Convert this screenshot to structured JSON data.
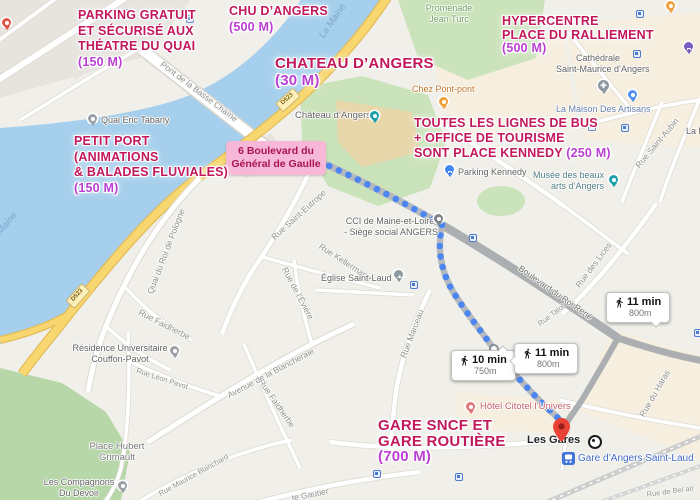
{
  "annotations": {
    "parking_quai": {
      "line1": "PARKING GRATUIT",
      "line2": "ET SÉCURISÉ AUX",
      "line3": "THÉATRE DU QUAI",
      "distance": "(150 M)"
    },
    "chu": {
      "line1": "CHU D’ANGERS",
      "distance": "(500 M)"
    },
    "chateau": {
      "line1": "CHATEAU D’ANGERS",
      "distance": "(30 M)"
    },
    "hypercentre": {
      "line1": "HYPERCENTRE",
      "line2": "PLACE DU RALLIEMENT",
      "distance": "(500 M)"
    },
    "bus_office": {
      "line1": "TOUTES LES LIGNES DE BUS",
      "line2": "+ OFFICE DE TOURISME",
      "line3": "SONT PLACE KENNEDY",
      "distance": "(250 M)"
    },
    "petit_port": {
      "line1": "PETIT PORT",
      "line2": "(ANIMATIONS",
      "line3": "& BALADES FLUVIALES)",
      "distance": "(150 M)"
    },
    "gare": {
      "line1": "GARE SNCF ET",
      "line2": "GARE ROUTIÈRE",
      "distance": "(700 M)"
    }
  },
  "address_box": {
    "line1": "6 Boulevard du",
    "line2": "Général de Gaulle"
  },
  "route_badges": [
    {
      "time": "10 min",
      "distance": "750m"
    },
    {
      "time": "11 min",
      "distance": "800m"
    },
    {
      "time": "11 min",
      "distance": "800m"
    }
  ],
  "pois": {
    "quai_tabarly": "Quai Eric Tabarly",
    "promenade1": "Promenade",
    "promenade2": "Jean Turc",
    "chez_pont_pont": "Chez Pont-pont",
    "chateau_label": "Château d’Angers",
    "cathedrale1": "Cathédrale",
    "cathedrale2": "Saint-Maurice d’Angers",
    "maison_artisans": "La Maison Des Artisans",
    "musee1": "Musée des beaux",
    "musee2": "arts d’Angers",
    "parking_kennedy": "Parking Kennedy",
    "cci1": "CCI de Maine-et-Loire",
    "cci2": "- Siège social ANGERS",
    "eglise": "Église Saint-Laud",
    "residence1": "Résidence Universitaire",
    "residence2": "Couffon-Pavot",
    "place_hubert1": "Place Hubert",
    "place_hubert2": "Grimault",
    "compagnons1": "Les Compagnons",
    "compagnons2": "Du Devoir",
    "hotel": "Hôtel Citotel l’Univers",
    "les_gares": "Les Gares",
    "gare_saint_laud": "Gare d’Angers Saint-Laud",
    "la_pr": "La Pr"
  },
  "streets": {
    "pont_basse_chaine": "Pont de la Basse Chaîne",
    "la_maine": "La Maine",
    "quai_roi_pologne": "Quai du Roi de Pologne",
    "rue_faidherbe": "Rue Faidherbe",
    "rue_saint_eutrope": "Rue Saint-Eutrope",
    "rue_kellermann": "Rue Kellermann",
    "rue_eviere": "Rue de l’Évière",
    "rue_marceau": "Rue Marceau",
    "bd_roi_rene": "Boulevard du Roi René",
    "rue_des_lices": "Rue des Lices",
    "rue_saint_aubin": "Rue Saint-Aubin",
    "rue_talot": "Rue Talot",
    "rue_du_haras": "Rue du Haras",
    "rue_bel_air": "Rue de Bel air",
    "av_blancheraie": "Avenue de la Blancheraie",
    "rue_leon_pavot": "Rue Léon Pavot",
    "rue_maurice_blanchard": "Rue Maurice Blanchard",
    "gautier": "te Gautier",
    "shield": "D523"
  },
  "colors": {
    "annotation_pink": "#c2185b",
    "annotation_magenta": "#bb3fd3",
    "address_box_bg": "#f7b7d7",
    "route_blue": "#4b85f2",
    "water": "#a5cfec",
    "destination_red": "#EA4335"
  }
}
